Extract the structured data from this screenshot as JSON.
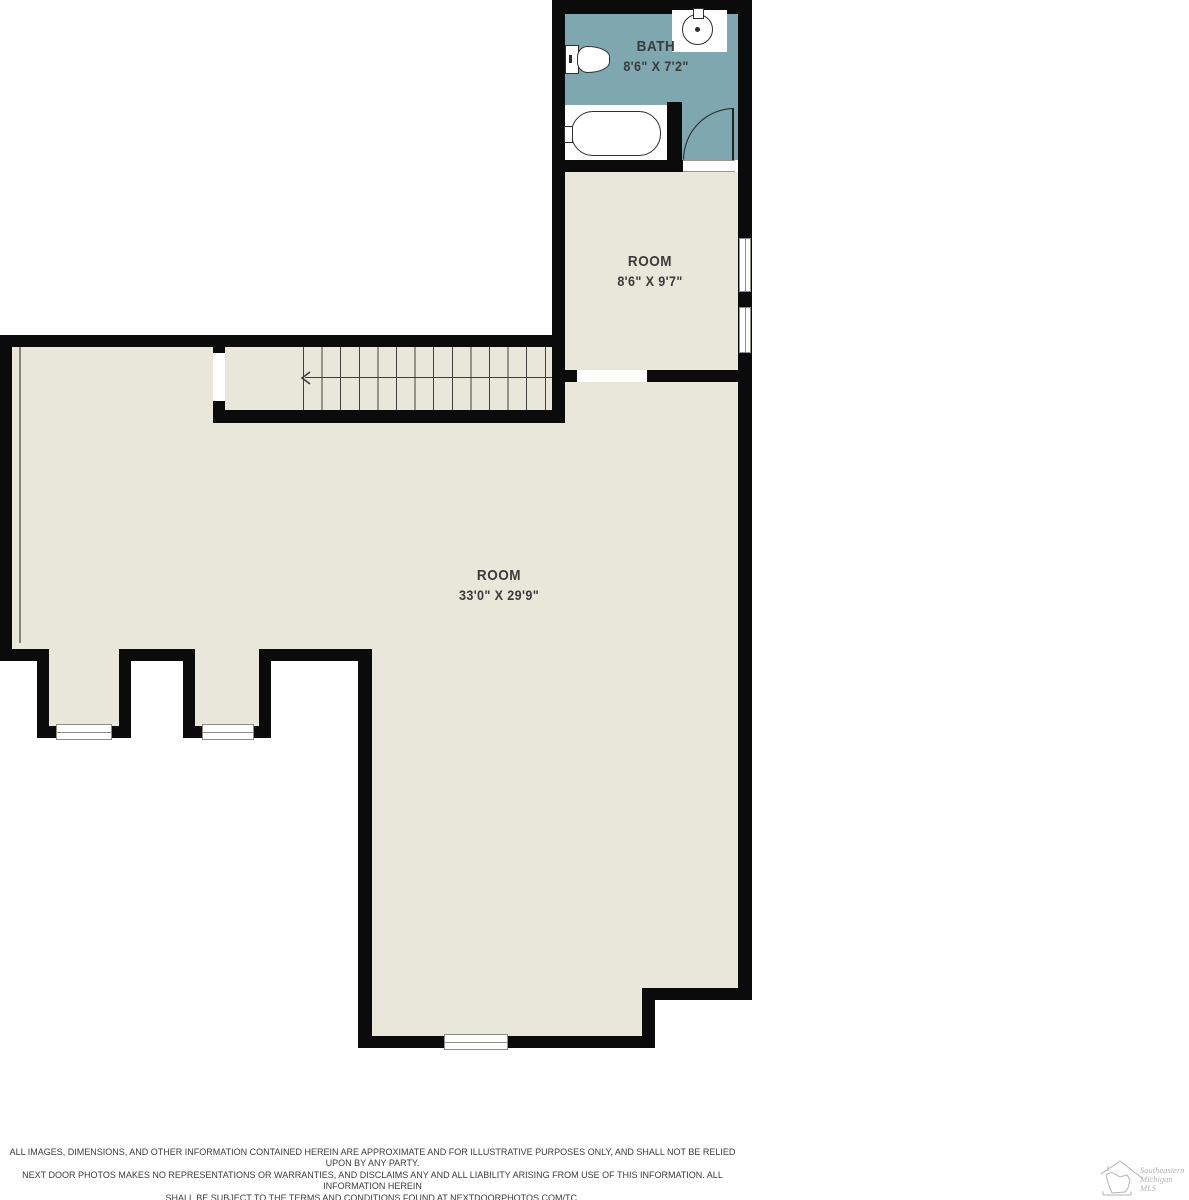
{
  "colors": {
    "wall": "#0b0b0b",
    "floor": "#e9e7da",
    "bath_floor": "#7fa7b0",
    "label_text": "#3b3b3b",
    "logo_gray": "#b3b3b3"
  },
  "rooms": {
    "bath": {
      "label": "BATH",
      "dims": "8'6\" X 7'2\""
    },
    "room_small": {
      "label": "ROOM",
      "dims": "8'6\" X 9'7\""
    },
    "room_large": {
      "label": "ROOM",
      "dims": "33'0\" X 29'9\""
    }
  },
  "stairs": {
    "direction": "left"
  },
  "disclaimer": {
    "line1": "ALL IMAGES, DIMENSIONS, AND OTHER INFORMATION CONTAINED HEREIN ARE APPROXIMATE AND FOR ILLUSTRATIVE PURPOSES ONLY, AND SHALL NOT BE RELIED UPON BY ANY PARTY.",
    "line2": "NEXT DOOR PHOTOS MAKES NO REPRESENTATIONS OR WARRANTIES, AND DISCLAIMS ANY AND ALL LIABILITY ARISING FROM USE OF THIS INFORMATION. ALL INFORMATION HEREIN",
    "line3": "SHALL BE SUBJECT TO THE TERMS AND CONDITIONS FOUND AT NEXTDOORPHOTOS.COM/TC."
  },
  "logo": {
    "line1": "Southeastern",
    "line2": "Michigan",
    "line3": "MLS"
  }
}
